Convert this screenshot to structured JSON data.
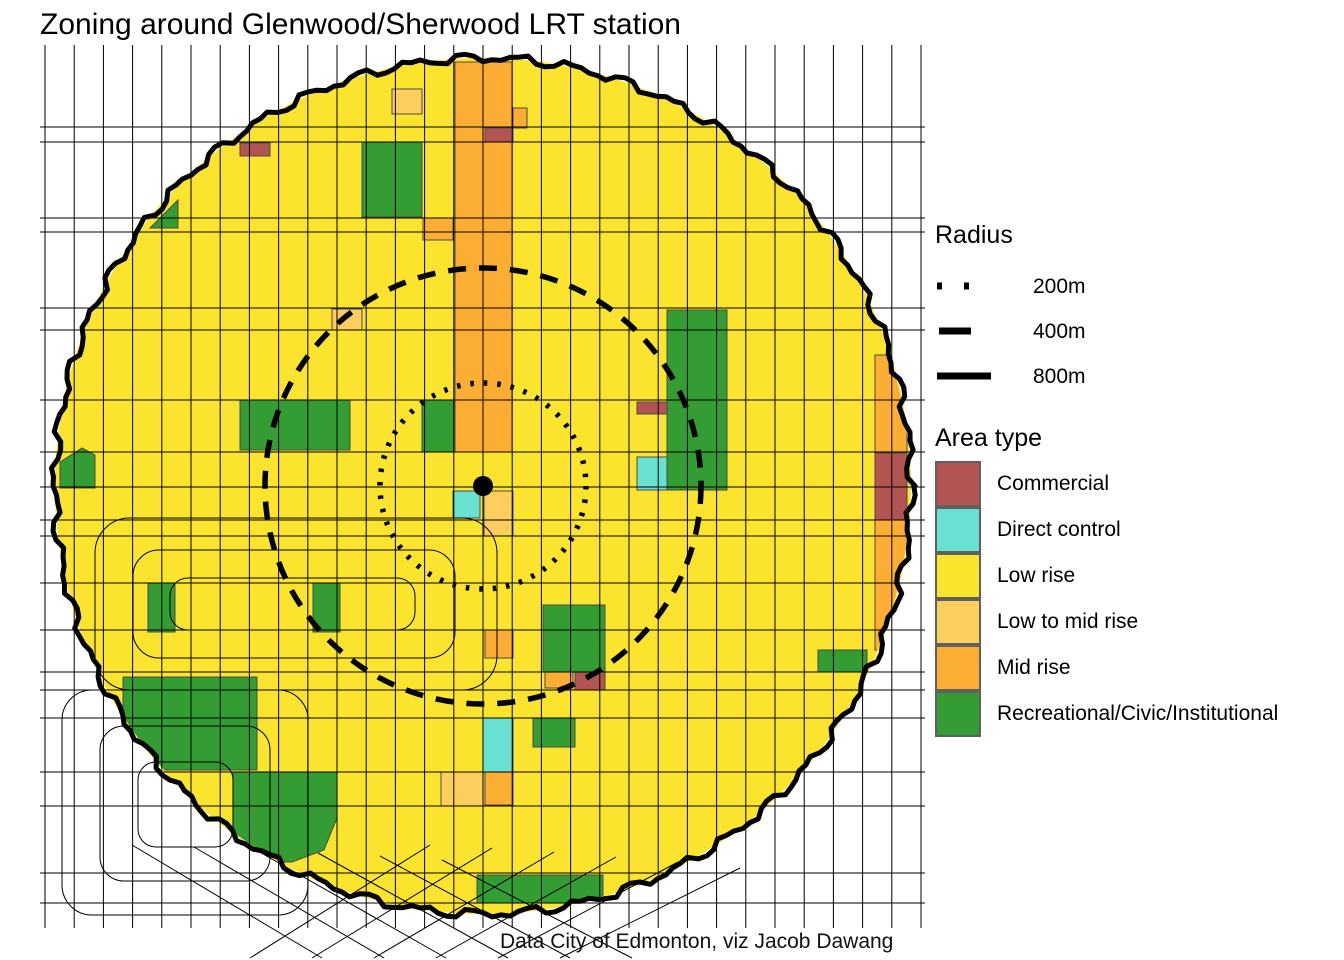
{
  "title": "Zoning around Glenwood/Sherwood LRT station",
  "caption": "Data City of Edmonton, viz Jacob Dawang",
  "legend": {
    "radius": {
      "heading": "Radius",
      "items": [
        {
          "label": "200m",
          "style": "dotted"
        },
        {
          "label": "400m",
          "style": "dashed"
        },
        {
          "label": "800m",
          "style": "solid"
        }
      ]
    },
    "area_type": {
      "heading": "Area type",
      "items": [
        {
          "label": "Commercial",
          "key": "commercial"
        },
        {
          "label": "Direct control",
          "key": "direct"
        },
        {
          "label": "Low rise",
          "key": "low_rise"
        },
        {
          "label": "Low to mid rise",
          "key": "low_mid"
        },
        {
          "label": "Mid rise",
          "key": "mid"
        },
        {
          "label": "Recreational/Civic/Institutional",
          "key": "green"
        }
      ]
    }
  },
  "map": {
    "colors": {
      "commercial": "#B25552",
      "direct": "#69E1D2",
      "low_rise": "#FBE42D",
      "low_mid": "#FCCE5D",
      "mid": "#FCAD33",
      "green": "#339C33",
      "patch_outline": "#4a4a4a",
      "grid_line": "#000000",
      "ring": "#000000"
    },
    "center": {
      "x": 483,
      "y": 486
    },
    "radii_px": {
      "r200": 103,
      "r400": 218,
      "r800": 428
    },
    "station_dot_radius": 10,
    "grid": {
      "left": 40,
      "right": 925,
      "top": 45,
      "bottom": 928,
      "x_start": 45,
      "x_step": 29.2,
      "x_count": 31,
      "rows": [
        127,
        142,
        218,
        232,
        308,
        330,
        400,
        452,
        487,
        520,
        536,
        583,
        630,
        672,
        690,
        718,
        772,
        806,
        873,
        903
      ]
    },
    "loops_inside": [
      [
        95,
        518,
        402,
        172,
        35
      ],
      [
        133,
        550,
        322,
        108,
        26
      ],
      [
        170,
        578,
        245,
        52,
        18
      ]
    ],
    "loops_outside": [
      [
        62,
        690,
        246,
        225,
        30
      ],
      [
        100,
        726,
        170,
        155,
        24
      ],
      [
        138,
        762,
        95,
        85,
        18
      ]
    ],
    "diagonals": [
      [
        250,
        958,
        430,
        845
      ],
      [
        312,
        958,
        492,
        848
      ],
      [
        374,
        958,
        554,
        852
      ],
      [
        436,
        958,
        616,
        857
      ],
      [
        498,
        958,
        678,
        862
      ],
      [
        560,
        958,
        740,
        868
      ],
      [
        132,
        845,
        322,
        958
      ],
      [
        194,
        847,
        384,
        958
      ],
      [
        256,
        850,
        446,
        958
      ],
      [
        318,
        853,
        508,
        958
      ],
      [
        380,
        856,
        570,
        958
      ],
      [
        442,
        860,
        632,
        958
      ]
    ],
    "patches": [
      {
        "t": "green",
        "poly": "150,228 178,200 178,228"
      },
      {
        "t": "green",
        "poly": "60,462 82,448 95,455 95,488 60,488"
      },
      {
        "t": "green",
        "poly": "233,772 337,772 337,818 324,850 292,862 233,862"
      },
      {
        "t": "green",
        "rect": [
          362,
          142,
          60,
          75
        ]
      },
      {
        "t": "green",
        "rect": [
          240,
          400,
          110,
          50
        ]
      },
      {
        "t": "green",
        "rect": [
          422,
          400,
          61,
          52
        ]
      },
      {
        "t": "green",
        "rect": [
          667,
          310,
          60,
          180
        ]
      },
      {
        "t": "green",
        "rect": [
          148,
          583,
          27,
          49
        ]
      },
      {
        "t": "green",
        "rect": [
          313,
          583,
          27,
          49
        ]
      },
      {
        "t": "green",
        "rect": [
          123,
          677,
          134,
          93
        ]
      },
      {
        "t": "green",
        "rect": [
          543,
          605,
          62,
          67
        ]
      },
      {
        "t": "green",
        "rect": [
          533,
          718,
          42,
          29
        ]
      },
      {
        "t": "green",
        "rect": [
          477,
          875,
          126,
          28
        ]
      },
      {
        "t": "green",
        "rect": [
          818,
          650,
          49,
          22
        ]
      },
      {
        "t": "mid",
        "rect": [
          455,
          62,
          57,
          390
        ]
      },
      {
        "t": "mid",
        "rect": [
          513,
          108,
          14,
          20
        ]
      },
      {
        "t": "mid",
        "rect": [
          423,
          218,
          30,
          22
        ]
      },
      {
        "t": "mid",
        "rect": [
          875,
          355,
          32,
          100
        ]
      },
      {
        "t": "mid",
        "rect": [
          875,
          520,
          32,
          130
        ]
      },
      {
        "t": "mid",
        "rect": [
          485,
          630,
          28,
          28
        ]
      },
      {
        "t": "mid",
        "rect": [
          545,
          672,
          28,
          16
        ]
      },
      {
        "t": "mid",
        "rect": [
          485,
          772,
          28,
          33
        ]
      },
      {
        "t": "low_mid",
        "rect": [
          392,
          89,
          30,
          25
        ]
      },
      {
        "t": "low_mid",
        "rect": [
          332,
          309,
          30,
          21
        ]
      },
      {
        "t": "low_mid",
        "rect": [
          484,
          491,
          29,
          45
        ]
      },
      {
        "t": "low_mid",
        "rect": [
          441,
          772,
          44,
          34
        ]
      },
      {
        "t": "commercial",
        "rect": [
          240,
          143,
          30,
          13
        ]
      },
      {
        "t": "commercial",
        "rect": [
          485,
          128,
          28,
          14
        ]
      },
      {
        "t": "commercial",
        "rect": [
          637,
          402,
          30,
          12
        ]
      },
      {
        "t": "commercial",
        "rect": [
          875,
          453,
          32,
          67
        ]
      },
      {
        "t": "commercial",
        "rect": [
          575,
          672,
          30,
          18
        ]
      },
      {
        "t": "direct",
        "rect": [
          453,
          491,
          27,
          27
        ]
      },
      {
        "t": "direct",
        "rect": [
          637,
          457,
          30,
          33
        ]
      },
      {
        "t": "direct",
        "rect": [
          483,
          718,
          30,
          54
        ]
      }
    ]
  }
}
